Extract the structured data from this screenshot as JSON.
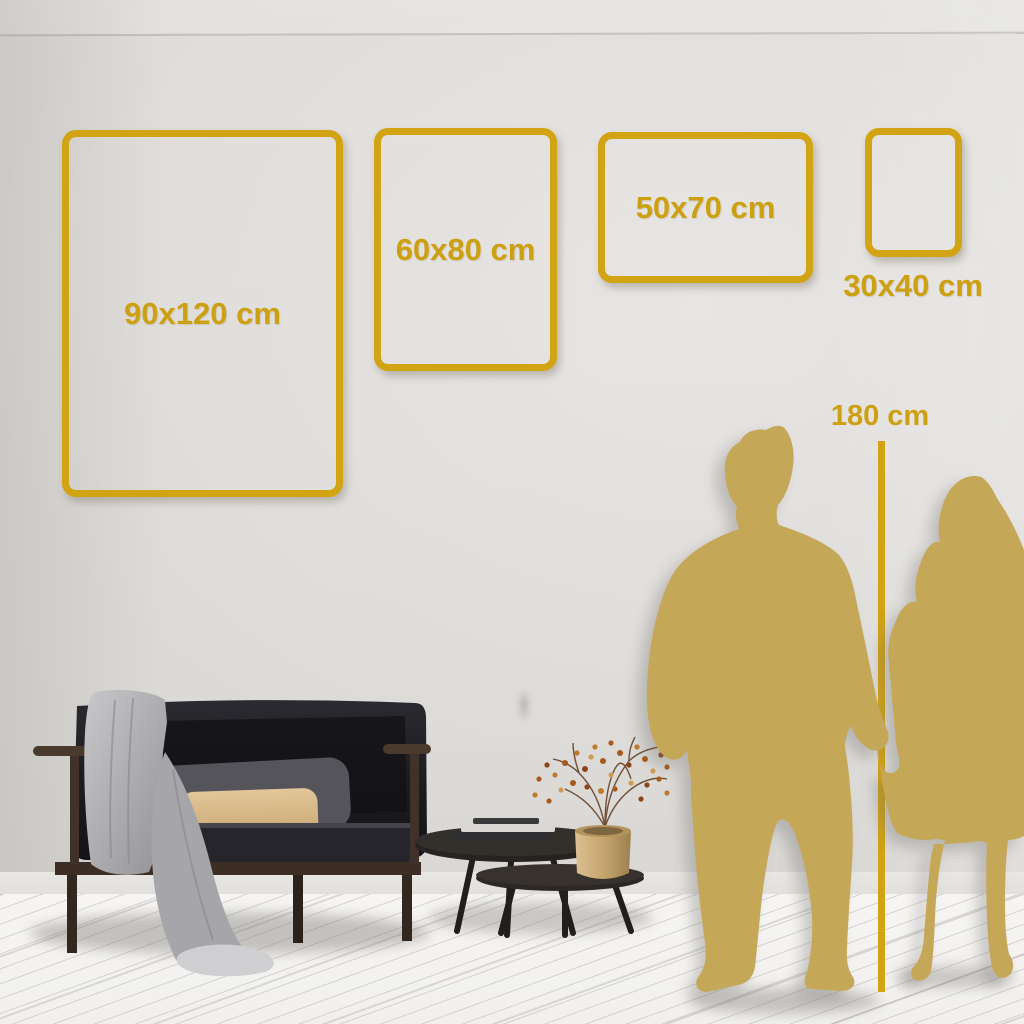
{
  "title": "Poster size guide wall scene",
  "frames": [
    {
      "label": "90x120 cm",
      "width_cm": 90,
      "height_cm": 120
    },
    {
      "label": "60x80 cm",
      "width_cm": 60,
      "height_cm": 80
    },
    {
      "label": "50x70 cm",
      "width_cm": 50,
      "height_cm": 70
    },
    {
      "label": "30x40 cm",
      "width_cm": 30,
      "height_cm": 40
    }
  ],
  "scale": {
    "label": "180 cm",
    "height_cm": 180
  },
  "colors": {
    "frame_gold": "#D2A312",
    "label_gold": "#CDA011",
    "silhouette": "#C5A758",
    "wall": "#DEDBD8",
    "floor": "#F4F3F1",
    "sofa_dark": "#212025",
    "wood_brown": "#3C2E24",
    "pillow_tan": "#D8B98C",
    "blanket_gray": "#B3B2B4",
    "brass": "#C6A56E"
  },
  "icons": {
    "couple": "couple-holding-hands-silhouette",
    "ruler": "height-reference-line"
  }
}
